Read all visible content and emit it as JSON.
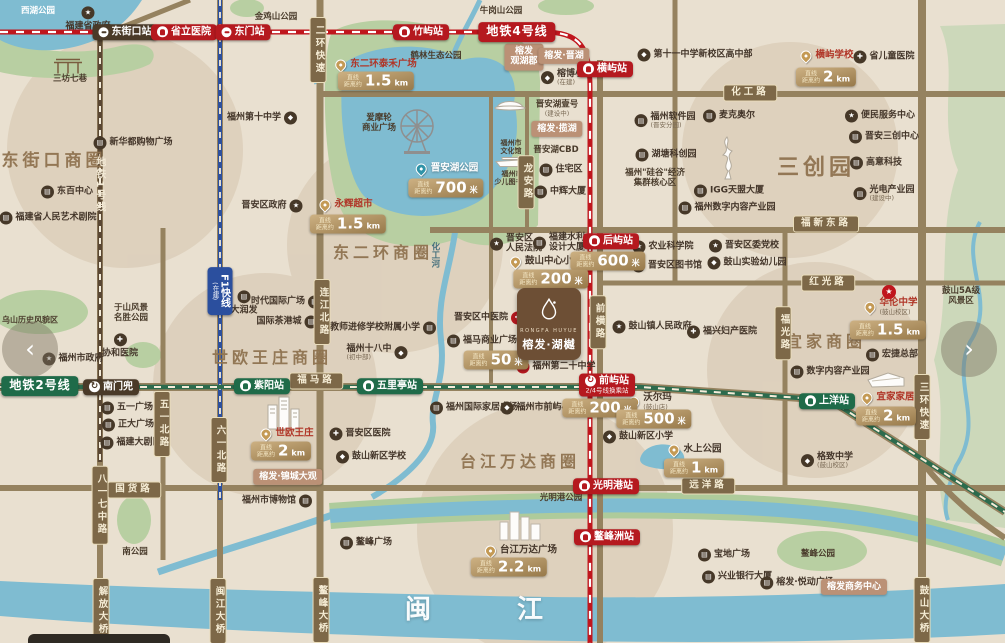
{
  "palette": {
    "land": "#e9e0d0",
    "water": "#7fbcd1",
    "park": "#b8cfa2",
    "mountain": "#ccd8ba",
    "road": "#95825f",
    "metro4_red": "#c0161d",
    "metro1_brown": "#5a4733",
    "metro2_green": "#2c6b4d",
    "f1_blue": "#2b4f9e",
    "badge_red": "#b5191f",
    "badge_green": "#1f6b49",
    "badge_dark": "#4a3a28",
    "dist_gold": "#ab8c5b",
    "dev_salmon": "#bb9176",
    "area_text": "#8f7350"
  },
  "carousel": {
    "prev": "‹",
    "next": "›"
  },
  "logo": {
    "en": "RONGFA HUYUE",
    "cn": "榕发·湖樾"
  },
  "dist_prefix": [
    "直线",
    "距离约"
  ],
  "items": [
    {
      "t": "station",
      "x": 125,
      "y": 32,
      "txt": "东街口站",
      "c": "dark",
      "ic": "metro"
    },
    {
      "t": "station",
      "x": 184,
      "y": 32,
      "txt": "省立医院",
      "c": "red",
      "ic": "train"
    },
    {
      "t": "station",
      "x": 243,
      "y": 32,
      "txt": "东门站",
      "c": "red",
      "ic": "metro"
    },
    {
      "t": "station",
      "x": 421,
      "y": 32,
      "txt": "竹屿站",
      "c": "red",
      "ic": "train"
    },
    {
      "t": "line",
      "x": 517,
      "y": 32,
      "txt": "地铁4号线",
      "c": "red"
    },
    {
      "t": "station",
      "x": 605,
      "y": 69,
      "txt": "横屿站",
      "c": "red",
      "ic": "train"
    },
    {
      "t": "station",
      "x": 611,
      "y": 241,
      "txt": "后屿站",
      "c": "red",
      "ic": "train"
    },
    {
      "t": "station",
      "x": 607,
      "y": 385,
      "txt": "前屿站",
      "c": "red",
      "ic": "xfer",
      "sub": "2/4号线换乘站"
    },
    {
      "t": "station",
      "x": 606,
      "y": 486,
      "txt": "光明港站",
      "c": "red",
      "ic": "train"
    },
    {
      "t": "station",
      "x": 607,
      "y": 537,
      "txt": "鳌峰洲站",
      "c": "red",
      "ic": "train"
    },
    {
      "t": "line",
      "x": 40,
      "y": 386,
      "txt": "地铁2号线",
      "c": "green"
    },
    {
      "t": "station",
      "x": 111,
      "y": 387,
      "txt": "南门兜",
      "c": "dark",
      "ic": "xfer"
    },
    {
      "t": "station",
      "x": 262,
      "y": 386,
      "txt": "紫阳站",
      "c": "green",
      "ic": "train"
    },
    {
      "t": "station",
      "x": 390,
      "y": 386,
      "txt": "五里亭站",
      "c": "green",
      "ic": "train"
    },
    {
      "t": "station",
      "x": 827,
      "y": 401,
      "txt": "上洋站",
      "c": "green",
      "ic": "train"
    },
    {
      "t": "line",
      "x": 220,
      "y": 291,
      "txt": "F1快线",
      "c": "blue",
      "v": 1,
      "sub": "(在建)"
    },
    {
      "t": "road",
      "x": 318,
      "y": 50,
      "txt": "二环快速",
      "v": 1
    },
    {
      "t": "road",
      "x": 750,
      "y": 93,
      "txt": "化工路"
    },
    {
      "t": "road",
      "x": 826,
      "y": 224,
      "txt": "福新东路"
    },
    {
      "t": "road",
      "x": 828,
      "y": 283,
      "txt": "红光路"
    },
    {
      "t": "road",
      "x": 322,
      "y": 312,
      "txt": "连江北路",
      "v": 1
    },
    {
      "t": "road",
      "x": 526,
      "y": 182,
      "txt": "龙安路",
      "v": 1
    },
    {
      "t": "road",
      "x": 598,
      "y": 322,
      "txt": "前横路",
      "v": 1
    },
    {
      "t": "road",
      "x": 783,
      "y": 333,
      "txt": "福光路",
      "v": 1
    },
    {
      "t": "road",
      "x": 922,
      "y": 407,
      "txt": "三环快速",
      "v": 1
    },
    {
      "t": "road",
      "x": 316,
      "y": 381,
      "txt": "福马路"
    },
    {
      "t": "road",
      "x": 134,
      "y": 490,
      "txt": "国货路"
    },
    {
      "t": "road",
      "x": 708,
      "y": 486,
      "txt": "远洋路"
    },
    {
      "t": "road",
      "x": 162,
      "y": 424,
      "txt": "五一北路",
      "v": 1
    },
    {
      "t": "road",
      "x": 219,
      "y": 450,
      "txt": "六一北路",
      "v": 1
    },
    {
      "t": "road",
      "x": 100,
      "y": 505,
      "txt": "八一七中路",
      "v": 1
    },
    {
      "t": "road",
      "x": 101,
      "y": 611,
      "txt": "解放大桥",
      "v": 1
    },
    {
      "t": "road",
      "x": 218,
      "y": 611,
      "txt": "闽江大桥",
      "v": 1
    },
    {
      "t": "road",
      "x": 321,
      "y": 610,
      "txt": "鳌峰大桥",
      "v": 1
    },
    {
      "t": "road",
      "x": 922,
      "y": 610,
      "txt": "鼓山大桥",
      "v": 1
    },
    {
      "t": "dist",
      "x": 376,
      "y": 81,
      "val": "1.5",
      "unit": "km"
    },
    {
      "t": "dist",
      "x": 446,
      "y": 188,
      "val": "700",
      "unit": "米"
    },
    {
      "t": "dist",
      "x": 348,
      "y": 224,
      "val": "1.5",
      "unit": "km"
    },
    {
      "t": "dist",
      "x": 826,
      "y": 77,
      "val": "2",
      "unit": "km"
    },
    {
      "t": "dist",
      "x": 608,
      "y": 261,
      "val": "600",
      "unit": "米"
    },
    {
      "t": "dist",
      "x": 551,
      "y": 279,
      "val": "200",
      "unit": "米"
    },
    {
      "t": "dist",
      "x": 496,
      "y": 360,
      "val": "50",
      "unit": "米"
    },
    {
      "t": "dist",
      "x": 600,
      "y": 408,
      "val": "200",
      "unit": "米"
    },
    {
      "t": "dist",
      "x": 654,
      "y": 419,
      "val": "500",
      "unit": "米"
    },
    {
      "t": "dist",
      "x": 888,
      "y": 330,
      "val": "1.5",
      "unit": "km"
    },
    {
      "t": "dist",
      "x": 886,
      "y": 416,
      "val": "2",
      "unit": "km"
    },
    {
      "t": "dist",
      "x": 694,
      "y": 468,
      "val": "1",
      "unit": "km"
    },
    {
      "t": "dist",
      "x": 281,
      "y": 451,
      "val": "2",
      "unit": "km"
    },
    {
      "t": "dist",
      "x": 509,
      "y": 567,
      "val": "2.2",
      "unit": "km"
    },
    {
      "t": "pin",
      "x": 376,
      "y": 65,
      "txt": "东二环泰禾广场",
      "tc": "red"
    },
    {
      "t": "pin",
      "x": 346,
      "y": 205,
      "txt": "永辉超市",
      "tc": "red"
    },
    {
      "t": "pin",
      "x": 447,
      "y": 169,
      "txt": "晋安湖公园",
      "tc": "white",
      "pc": "teal"
    },
    {
      "t": "pin",
      "x": 827,
      "y": 56,
      "txt": "横屿学校",
      "tc": "red"
    },
    {
      "t": "pin",
      "x": 891,
      "y": 307,
      "txt": "华伦中学",
      "tc": "red",
      "sub": "(鼓山校区)"
    },
    {
      "t": "pin",
      "x": 888,
      "y": 398,
      "txt": "宜家家居",
      "tc": "red"
    },
    {
      "t": "pin",
      "x": 287,
      "y": 434,
      "txt": "世欧王庄",
      "tc": "red"
    },
    {
      "t": "pin",
      "x": 521,
      "y": 551,
      "txt": "台江万达广场",
      "tc": "brown"
    },
    {
      "t": "pin",
      "x": 695,
      "y": 450,
      "txt": "水上公园",
      "tc": "brown"
    },
    {
      "t": "pin",
      "x": 650,
      "y": 402,
      "txt": "沃尔玛",
      "tc": "brown",
      "sub": "(鼓山店)"
    },
    {
      "t": "pin",
      "x": 546,
      "y": 262,
      "txt": "鼓山中心小学",
      "tc": "brown"
    },
    {
      "t": "poi",
      "x": 88,
      "y": 19,
      "txt": "福建省政府",
      "ic": "star",
      "side": "t"
    },
    {
      "t": "poi",
      "x": 133,
      "y": 143,
      "txt": "新华都购物广场",
      "ic": "bldg"
    },
    {
      "t": "poi",
      "x": 67,
      "y": 192,
      "txt": "东百中心",
      "ic": "bldg"
    },
    {
      "t": "poi",
      "x": 48,
      "y": 218,
      "txt": "福建省人民艺术剧院",
      "ic": "bldg"
    },
    {
      "t": "poi",
      "x": 262,
      "y": 118,
      "txt": "福州第十中学",
      "ic": "school",
      "side": "r"
    },
    {
      "t": "poi",
      "x": 272,
      "y": 206,
      "txt": "晋安区政府",
      "ic": "star",
      "side": "r"
    },
    {
      "t": "poi",
      "x": 567,
      "y": 78,
      "txt": "榕博小学",
      "ic": "school",
      "sub": "(在建)"
    },
    {
      "t": "poi",
      "x": 561,
      "y": 170,
      "txt": "住宅区",
      "ic": "bldg"
    },
    {
      "t": "poi",
      "x": 560,
      "y": 192,
      "txt": "中辉大厦",
      "ic": "bldg"
    },
    {
      "t": "poi",
      "x": 286,
      "y": 302,
      "txt": "时代国际广场",
      "ic": "bldg",
      "side": "r"
    },
    {
      "t": "poi",
      "x": 287,
      "y": 322,
      "txt": "国际茶港城",
      "ic": "bldg",
      "side": "r"
    },
    {
      "t": "poi",
      "x": 244,
      "y": 303,
      "txt": "大润发",
      "ic": "bldg",
      "side": "t"
    },
    {
      "t": "poi",
      "x": 383,
      "y": 328,
      "txt": "教师进修学校附属小学",
      "ic": "bldg",
      "side": "r"
    },
    {
      "t": "poi",
      "x": 377,
      "y": 353,
      "txt": "福州十八中",
      "ic": "school",
      "side": "r",
      "sub": "(初中部)"
    },
    {
      "t": "poi",
      "x": 516,
      "y": 244,
      "lines": [
        "晋安区",
        "人民法院"
      ],
      "ic": "star"
    },
    {
      "t": "poi",
      "x": 559,
      "y": 243,
      "lines": [
        "福建水利",
        "设计大厦"
      ],
      "ic": "bldg"
    },
    {
      "t": "poi",
      "x": 663,
      "y": 247,
      "txt": "农业科学院",
      "ic": "star"
    },
    {
      "t": "poi",
      "x": 667,
      "y": 266,
      "txt": "晋安区图书馆",
      "ic": "bldg"
    },
    {
      "t": "poi",
      "x": 652,
      "y": 327,
      "txt": "鼓山镇人民政府",
      "ic": "star"
    },
    {
      "t": "poi",
      "x": 489,
      "y": 318,
      "txt": "晋安区中医院",
      "ic": "cross",
      "side": "r",
      "icc": "red"
    },
    {
      "t": "poi",
      "x": 482,
      "y": 341,
      "txt": "福马商业广场",
      "ic": "bldg"
    },
    {
      "t": "poi",
      "x": 556,
      "y": 367,
      "txt": "福州第二十中学",
      "ic": "school",
      "icc": "red"
    },
    {
      "t": "poi",
      "x": 474,
      "y": 408,
      "txt": "福州国际家居广场",
      "ic": "bldg"
    },
    {
      "t": "poi",
      "x": 540,
      "y": 408,
      "txt": "福州市前屿小学",
      "ic": "school"
    },
    {
      "t": "poi",
      "x": 120,
      "y": 346,
      "txt": "协和医院",
      "ic": "cross",
      "side": "t"
    },
    {
      "t": "poi",
      "x": 73,
      "y": 359,
      "txt": "福州市政府",
      "ic": "star"
    },
    {
      "t": "poi",
      "x": 127,
      "y": 408,
      "txt": "五一广场",
      "ic": "bldg"
    },
    {
      "t": "poi",
      "x": 128,
      "y": 425,
      "txt": "正大广场",
      "ic": "bldg"
    },
    {
      "t": "poi",
      "x": 131,
      "y": 443,
      "txt": "福建大剧院",
      "ic": "bldg"
    },
    {
      "t": "poi",
      "x": 277,
      "y": 501,
      "txt": "福州市博物馆",
      "ic": "bldg",
      "side": "r"
    },
    {
      "t": "poi",
      "x": 360,
      "y": 434,
      "txt": "晋安区医院",
      "ic": "cross"
    },
    {
      "t": "poi",
      "x": 371,
      "y": 457,
      "txt": "鼓山新区学校",
      "ic": "school"
    },
    {
      "t": "poi",
      "x": 638,
      "y": 437,
      "txt": "鼓山新区小学",
      "ic": "school"
    },
    {
      "t": "poi",
      "x": 366,
      "y": 543,
      "txt": "鳌峰广场",
      "ic": "bldg"
    },
    {
      "t": "poi",
      "x": 724,
      "y": 555,
      "txt": "宝地广场",
      "ic": "bldg"
    },
    {
      "t": "poi",
      "x": 737,
      "y": 577,
      "txt": "兴业银行大厦",
      "ic": "bldg"
    },
    {
      "t": "poi",
      "x": 797,
      "y": 583,
      "txt": "榕发·悦动广场",
      "ic": "bldg"
    },
    {
      "t": "poi",
      "x": 827,
      "y": 461,
      "txt": "格致中学",
      "ic": "school",
      "sub": "(鼓山校区)"
    },
    {
      "t": "poi",
      "x": 744,
      "y": 246,
      "txt": "晋安区委党校",
      "ic": "star"
    },
    {
      "t": "poi",
      "x": 747,
      "y": 263,
      "txt": "鼓山实验幼儿园",
      "ic": "school"
    },
    {
      "t": "poi",
      "x": 722,
      "y": 332,
      "txt": "福兴妇产医院",
      "ic": "cross"
    },
    {
      "t": "poi",
      "x": 892,
      "y": 355,
      "txt": "宏捷总部",
      "ic": "bldg"
    },
    {
      "t": "poi",
      "x": 830,
      "y": 372,
      "txt": "数字内容产业园",
      "ic": "bldg"
    },
    {
      "t": "poi",
      "x": 880,
      "y": 116,
      "txt": "便民服务中心",
      "ic": "star"
    },
    {
      "t": "poi",
      "x": 884,
      "y": 137,
      "txt": "晋安三创中心",
      "ic": "bldg"
    },
    {
      "t": "poi",
      "x": 876,
      "y": 163,
      "txt": "高意科技",
      "ic": "bldg"
    },
    {
      "t": "poi",
      "x": 884,
      "y": 194,
      "txt": "光电产业园",
      "ic": "bldg",
      "sub": "(建设中)"
    },
    {
      "t": "poi",
      "x": 729,
      "y": 116,
      "txt": "麦克奥尔",
      "ic": "bldg"
    },
    {
      "t": "poi",
      "x": 665,
      "y": 121,
      "txt": "福州软件园",
      "ic": "bldg",
      "sub": "(晋安分园)"
    },
    {
      "t": "poi",
      "x": 666,
      "y": 155,
      "txt": "湖塘科创园",
      "ic": "bldg"
    },
    {
      "t": "poi",
      "x": 729,
      "y": 191,
      "txt": "IGG天盟大厦",
      "ic": "bldg"
    },
    {
      "t": "poi",
      "x": 727,
      "y": 208,
      "txt": "福州数字内容产业园",
      "ic": "bldg"
    },
    {
      "t": "poi",
      "x": 695,
      "y": 55,
      "txt": "第十一中学新校区高中部",
      "ic": "school"
    },
    {
      "t": "poi",
      "x": 884,
      "y": 57,
      "txt": "省儿童医院",
      "ic": "cross"
    },
    {
      "t": "plain",
      "x": 38,
      "y": 12,
      "txt": "西湖公园",
      "c": "white"
    },
    {
      "t": "plain",
      "x": 276,
      "y": 18,
      "txt": "金鸡山公园"
    },
    {
      "t": "plain",
      "x": 501,
      "y": 12,
      "txt": "牛岗山公园"
    },
    {
      "t": "plain",
      "x": 436,
      "y": 57,
      "txt": "鹤林生态公园"
    },
    {
      "t": "plain",
      "x": 99,
      "y": 185,
      "txt": "地铁1号线",
      "v": 1,
      "c": "cream"
    },
    {
      "t": "plain",
      "x": 70,
      "y": 80,
      "txt": "三坊七巷"
    },
    {
      "t": "plain",
      "x": 379,
      "y": 124,
      "lines": [
        "爱摩轮",
        "商业广场"
      ]
    },
    {
      "t": "plain",
      "x": 511,
      "y": 147,
      "lines": [
        "福州市",
        "文化馆"
      ],
      "fs": 7
    },
    {
      "t": "plain",
      "x": 512,
      "y": 178,
      "lines": [
        "福州市",
        "少儿图书馆"
      ],
      "fs": 7
    },
    {
      "t": "plain",
      "x": 557,
      "y": 109,
      "txt": "晋安湖壹号",
      "sub": "(建设中)"
    },
    {
      "t": "plain",
      "x": 556,
      "y": 151,
      "txt": "晋安湖CBD"
    },
    {
      "t": "plain",
      "x": 434,
      "y": 255,
      "txt": "化工河",
      "v": 1,
      "c": "teal"
    },
    {
      "t": "plain",
      "x": 30,
      "y": 320,
      "txt": "乌山历史风貌区",
      "fs": 8
    },
    {
      "t": "plain",
      "x": 131,
      "y": 314,
      "lines": [
        "于山风景",
        "名胜公园"
      ]
    },
    {
      "t": "plain",
      "x": 135,
      "y": 553,
      "txt": "南公园"
    },
    {
      "t": "plain",
      "x": 561,
      "y": 499,
      "txt": "光明港公园"
    },
    {
      "t": "plain",
      "x": 818,
      "y": 555,
      "txt": "鳌峰公园"
    },
    {
      "t": "plain",
      "x": 655,
      "y": 179,
      "lines": [
        "福州\"硅谷\"经济",
        "集群核心区"
      ]
    },
    {
      "t": "plain",
      "x": 961,
      "y": 297,
      "lines": [
        "鼓山5A级",
        "风景区"
      ]
    },
    {
      "t": "area",
      "x": 54,
      "y": 162,
      "txt": "东街口商圈",
      "fs": 17
    },
    {
      "t": "area",
      "x": 383,
      "y": 253,
      "txt": "东二环商圈",
      "fs": 16
    },
    {
      "t": "area",
      "x": 272,
      "y": 358,
      "txt": "世欧王庄商圈",
      "fs": 16
    },
    {
      "t": "area",
      "x": 520,
      "y": 462,
      "txt": "台江万达商圈",
      "fs": 16
    },
    {
      "t": "area",
      "x": 826,
      "y": 342,
      "txt": "宜家商圈",
      "fs": 16
    },
    {
      "t": "area",
      "x": 816,
      "y": 168,
      "txt": "三创园",
      "fs": 22
    },
    {
      "t": "area",
      "x": 419,
      "y": 611,
      "txt": "闽",
      "fs": 26,
      "c": "white"
    },
    {
      "t": "area",
      "x": 531,
      "y": 611,
      "txt": "江",
      "fs": 26,
      "c": "white"
    },
    {
      "t": "dev",
      "x": 524,
      "y": 57,
      "lines": [
        "榕发",
        "观湖郡"
      ]
    },
    {
      "t": "dev",
      "x": 564,
      "y": 56,
      "txt": "榕发·晋湖"
    },
    {
      "t": "dev",
      "x": 557,
      "y": 129,
      "txt": "榕发·揽湖"
    },
    {
      "t": "dev",
      "x": 288,
      "y": 477,
      "txt": "榕发·锦城大观"
    },
    {
      "t": "dev",
      "x": 854,
      "y": 587,
      "txt": "榕发商务中心"
    },
    {
      "t": "illus",
      "x": 68,
      "y": 66,
      "name": "gate"
    },
    {
      "t": "illus",
      "x": 417,
      "y": 131,
      "name": "ferris"
    },
    {
      "t": "illus",
      "x": 510,
      "y": 103,
      "name": "dome"
    },
    {
      "t": "illus",
      "x": 511,
      "y": 162,
      "name": "boat"
    },
    {
      "t": "illus",
      "x": 286,
      "y": 413,
      "name": "towers"
    },
    {
      "t": "illus",
      "x": 521,
      "y": 525,
      "name": "wanda"
    },
    {
      "t": "illus",
      "x": 727,
      "y": 158,
      "name": "tower"
    },
    {
      "t": "illus",
      "x": 886,
      "y": 380,
      "name": "ikea"
    },
    {
      "t": "icon",
      "x": 889,
      "y": 292,
      "name": "redcircle",
      "glyph": "★"
    }
  ]
}
